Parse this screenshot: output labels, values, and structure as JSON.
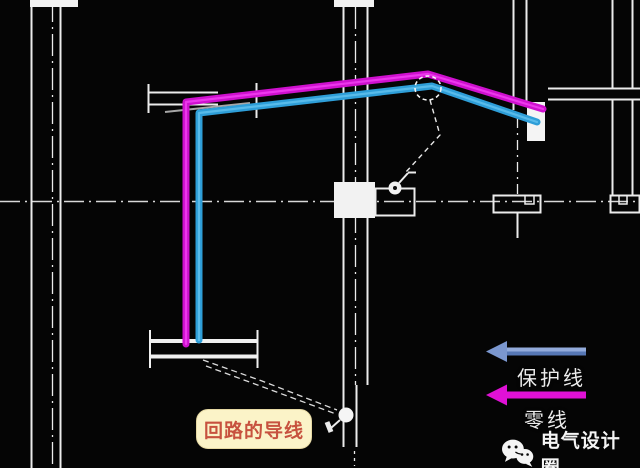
{
  "meta": {
    "app": "cad-electrical-wiring-plan",
    "canvas_width": 640,
    "canvas_height": 468,
    "background": "#050505"
  },
  "palette": {
    "wall_line": "#ececec",
    "neutral_wire": "#cf10cf",
    "neutral_wire_core": "#f341f3",
    "protective_wire": "#2e9ed8",
    "protective_wire_core": "#63c2ef",
    "legend_blue_head": "#7b97cf",
    "legend_blue_shaft_top": "#93abdb",
    "legend_blue_shaft_bottom": "#5677b5",
    "legend_magenta": "#e011d6",
    "callout_bg": "#fbf3c8",
    "callout_text": "#c7523f",
    "annotation_white": "#f5f5f5"
  },
  "legend": {
    "protective": {
      "label": "保护线",
      "icon": "left-arrow-icon"
    },
    "neutral": {
      "label": "零线",
      "icon": "left-arrow-icon"
    }
  },
  "callout": {
    "label": "回路的导线"
  },
  "watermark": {
    "label": "电气设计圈",
    "icon": "wechat-icon"
  },
  "symbols": {
    "junction_highlight": "dashed-ellipse over wire junction",
    "switch_top": "switch-symbol near distribution box",
    "switch_bottom": "switch-symbol at lower wall"
  }
}
